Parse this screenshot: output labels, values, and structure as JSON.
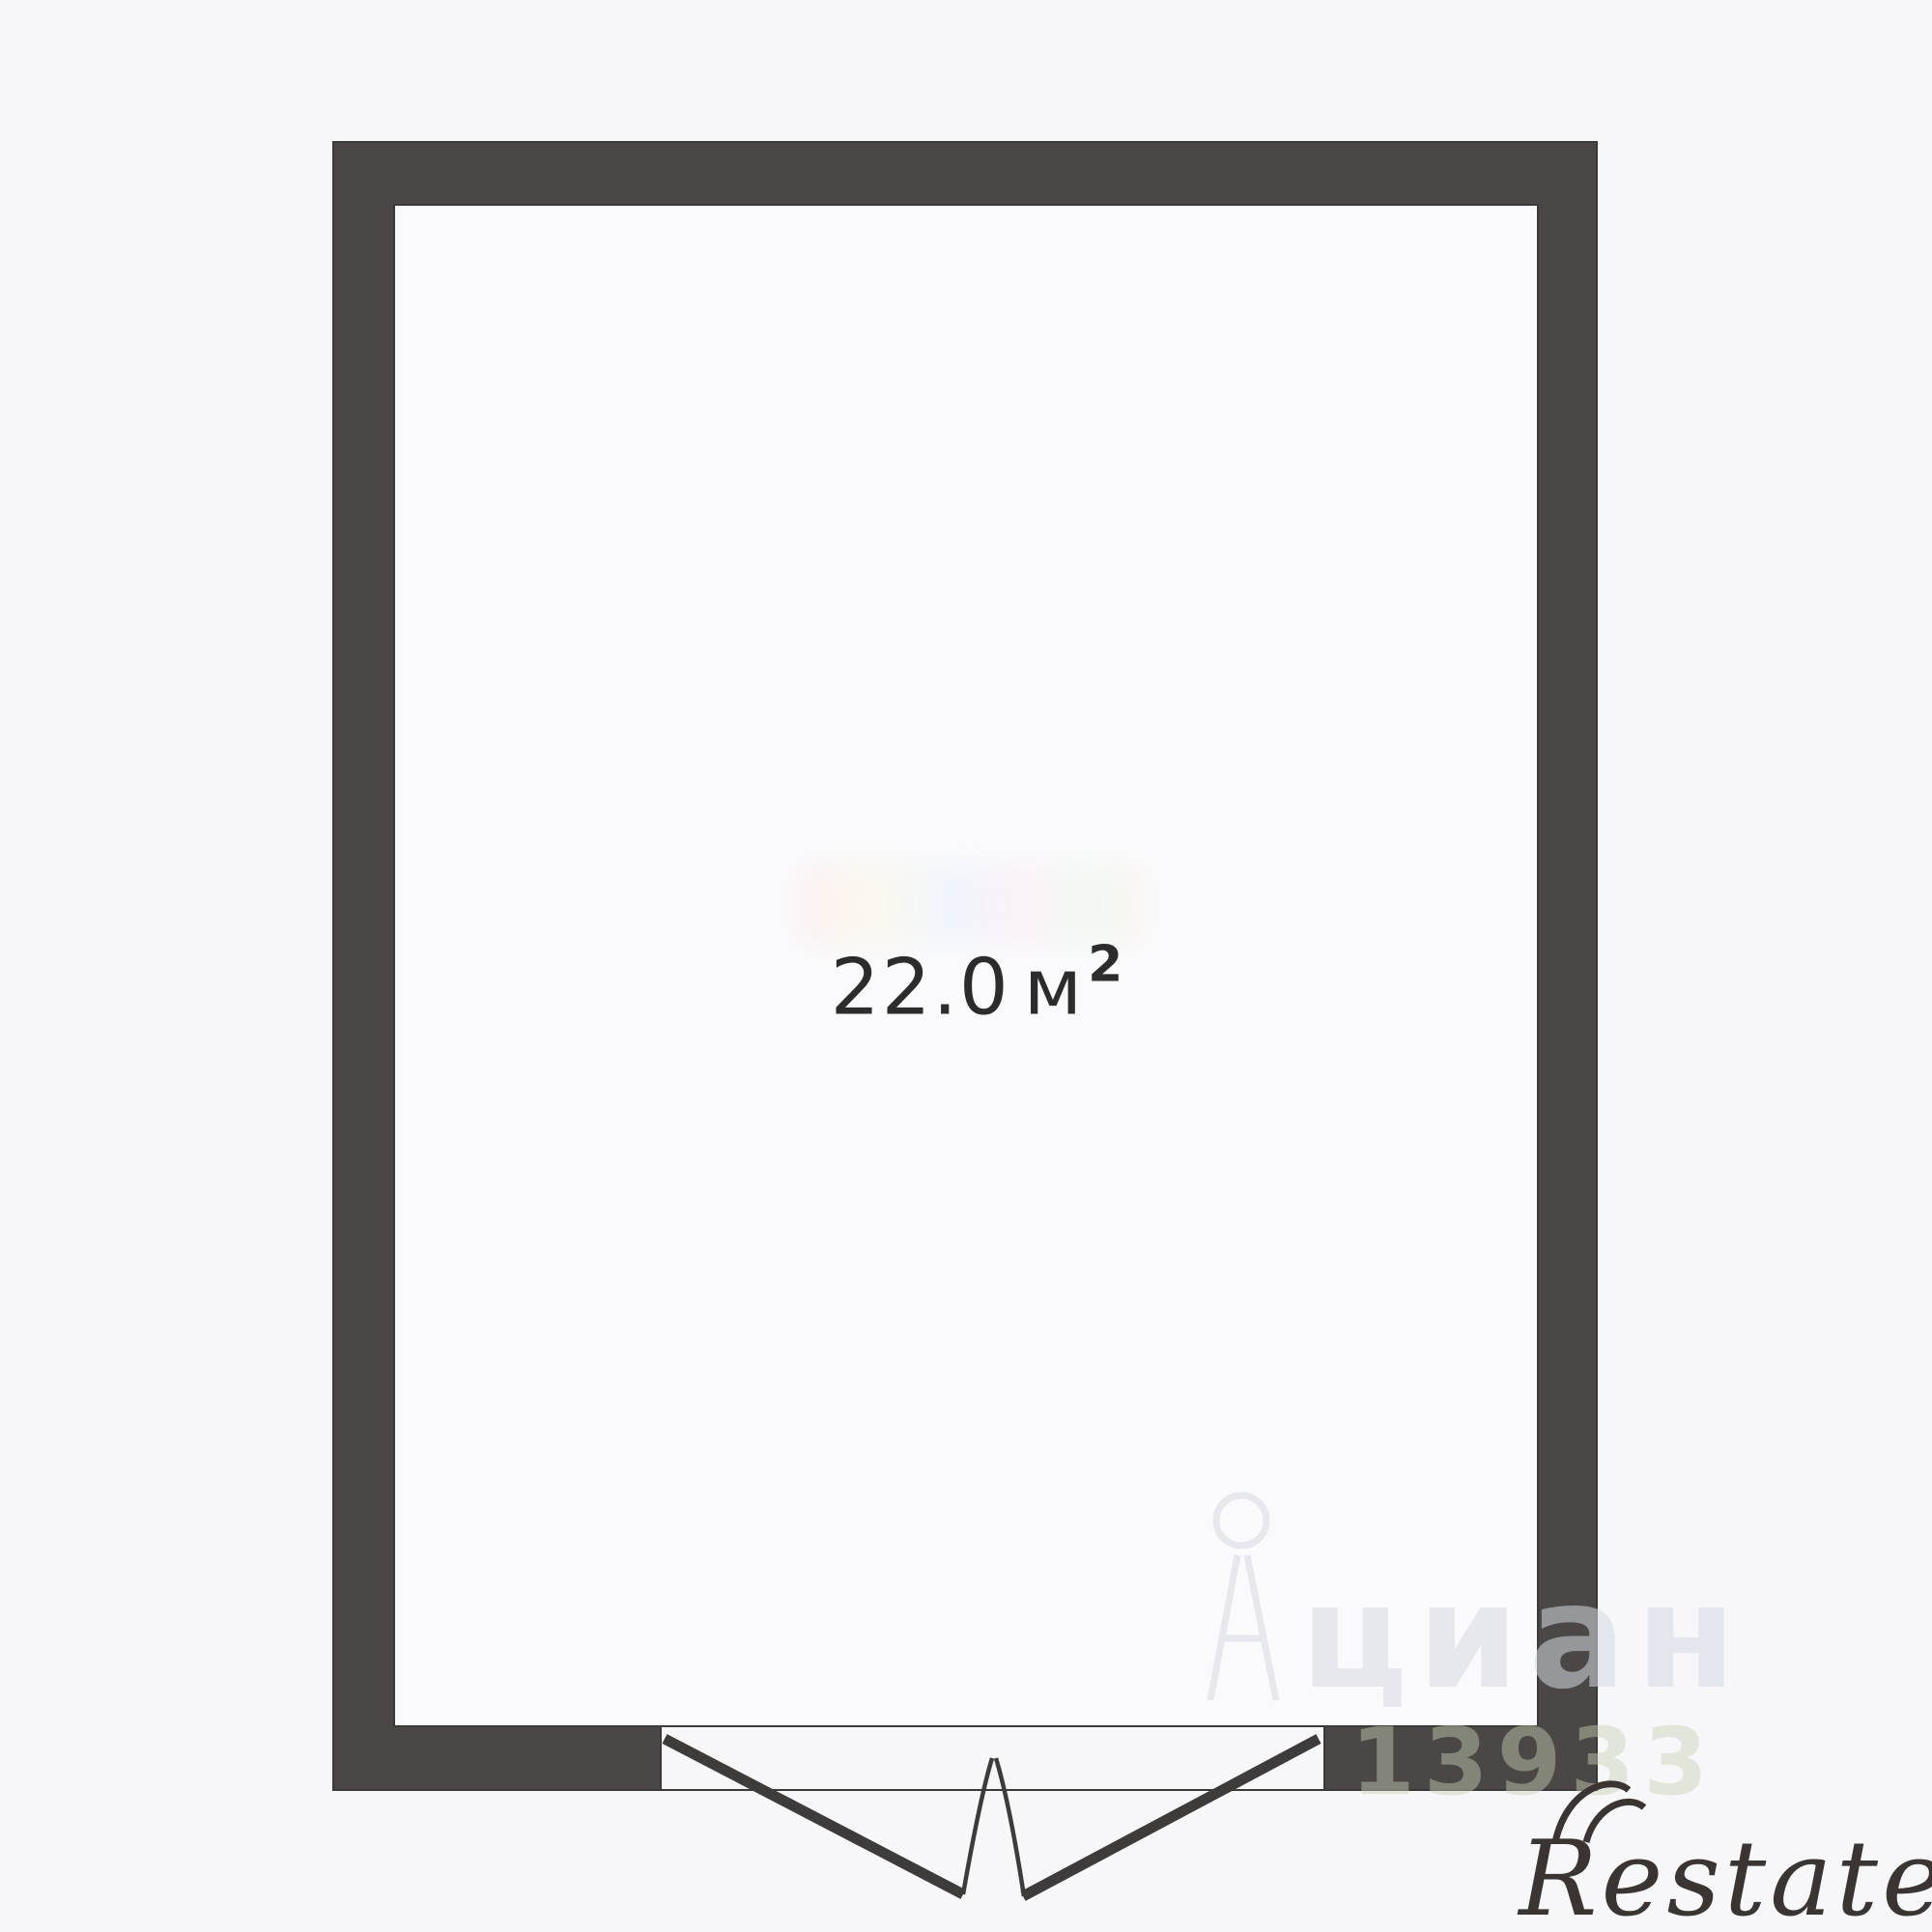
{
  "page": {
    "type": "floor-plan"
  },
  "room": {
    "area_value": "22.0",
    "area_unit": "м",
    "area_superscript": "2"
  },
  "watermarks": {
    "cian_logo_text": "циан",
    "cian_listing_id": "13933",
    "restate_logo_text": "Restate"
  },
  "colors": {
    "wall": "#4a4746",
    "wall_edge": "#3c3a39",
    "background": "#f7f7fa",
    "interior": "#fafafc",
    "area_label": "#2d2c2c",
    "door_line": "#3e3c3b",
    "restate_logo": "#3a3533",
    "cian_watermark": "#d5d8e1"
  }
}
